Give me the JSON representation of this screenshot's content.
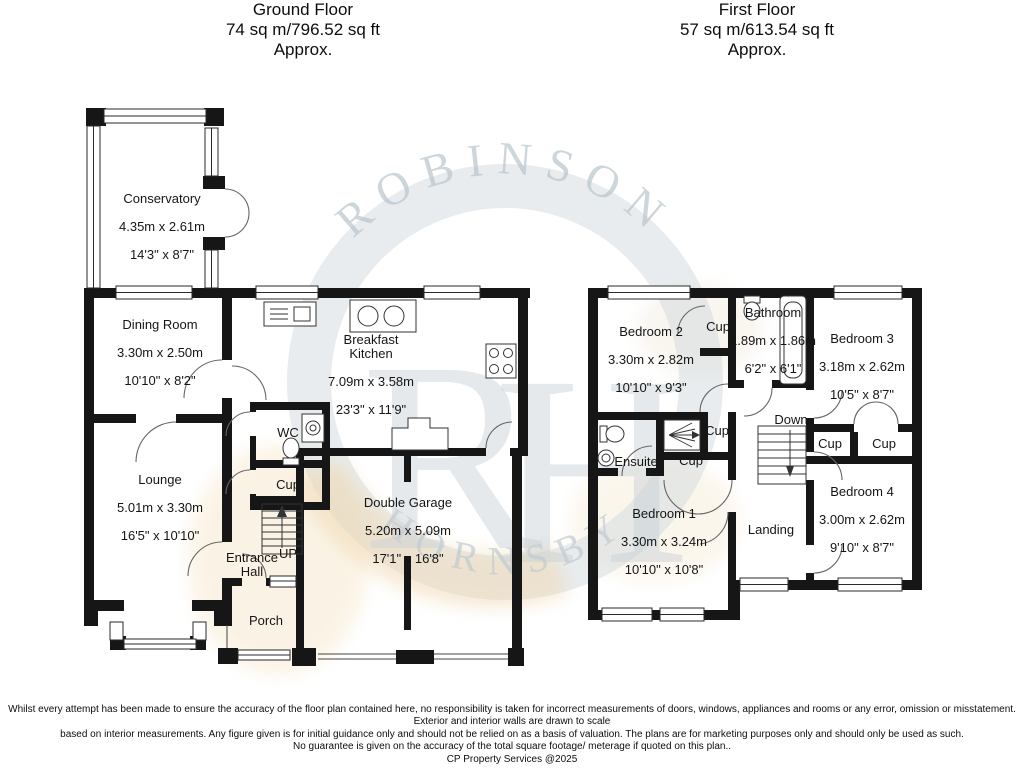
{
  "headers": {
    "ground": {
      "title": "Ground Floor",
      "area": "74 sq m/796.52 sq ft",
      "approx": "Approx."
    },
    "first": {
      "title": "First Floor",
      "area": "57 sq m/613.54 sq ft",
      "approx": "Approx."
    }
  },
  "rooms": {
    "conservatory": {
      "name": "Conservatory",
      "metric": "4.35m x 2.61m",
      "imperial": "14'3\" x 8'7\""
    },
    "dining_room": {
      "name": "Dining Room",
      "metric": "3.30m x 2.50m",
      "imperial": "10'10\" x 8'2\""
    },
    "breakfast_kitchen": {
      "name": "Breakfast\nKitchen",
      "metric": "7.09m x 3.58m",
      "imperial": "23'3\" x 11'9\""
    },
    "wc": {
      "name": "WC"
    },
    "lounge": {
      "name": "Lounge",
      "metric": "5.01m x 3.30m",
      "imperial": "16'5\" x 10'10\""
    },
    "entrance_hall": {
      "name": "Entrance\nHall"
    },
    "up": {
      "name": "UP"
    },
    "double_garage": {
      "name": "Double Garage",
      "metric": "5.20m x 5.09m",
      "imperial": "17'1\" x 16'8\""
    },
    "porch": {
      "name": "Porch"
    },
    "bedroom2": {
      "name": "Bedroom 2",
      "metric": "3.30m x 2.82m",
      "imperial": "10'10\" x 9'3\""
    },
    "bathroom": {
      "name": "Bathroom",
      "metric": "1.89m x 1.86m",
      "imperial": "6'2\" x 6'1\""
    },
    "bedroom3": {
      "name": "Bedroom 3",
      "metric": "3.18m x 2.62m",
      "imperial": "10'5\" x 8'7\""
    },
    "ensuite": {
      "name": "Ensuite"
    },
    "down": {
      "name": "Down"
    },
    "bedroom1": {
      "name": "Bedroom 1",
      "metric": "3.30m x 3.24m",
      "imperial": "10'10\" x 10'8\""
    },
    "landing": {
      "name": "Landing"
    },
    "bedroom4": {
      "name": "Bedroom 4",
      "metric": "3.00m x 2.62m",
      "imperial": "9'10\" x 8'7\""
    },
    "cupboard": {
      "name": "Cup"
    }
  },
  "watermark": {
    "arc_top": "ROBINSON",
    "arc_bottom": "HORNSBY",
    "monogram_r": "R",
    "monogram_h": "H"
  },
  "footer": {
    "line1": "Whilst every attempt has been made to ensure the accuracy of the floor plan contained here, no responsibility is taken for incorrect measurements of doors, windows, appliances and rooms or any error, omission or misstatement. Exterior and interior walls are drawn to scale",
    "line2": "based on interior measurements. Any figure given is for initial guidance only and should not be relied on as a basis of valuation. The plans are for marketing purposes only and should only be used as such.",
    "line3": "No guarantee is given on the accuracy of the total square footage/ meterage if quoted on this plan..",
    "line4": "CP Property Services @2025"
  }
}
